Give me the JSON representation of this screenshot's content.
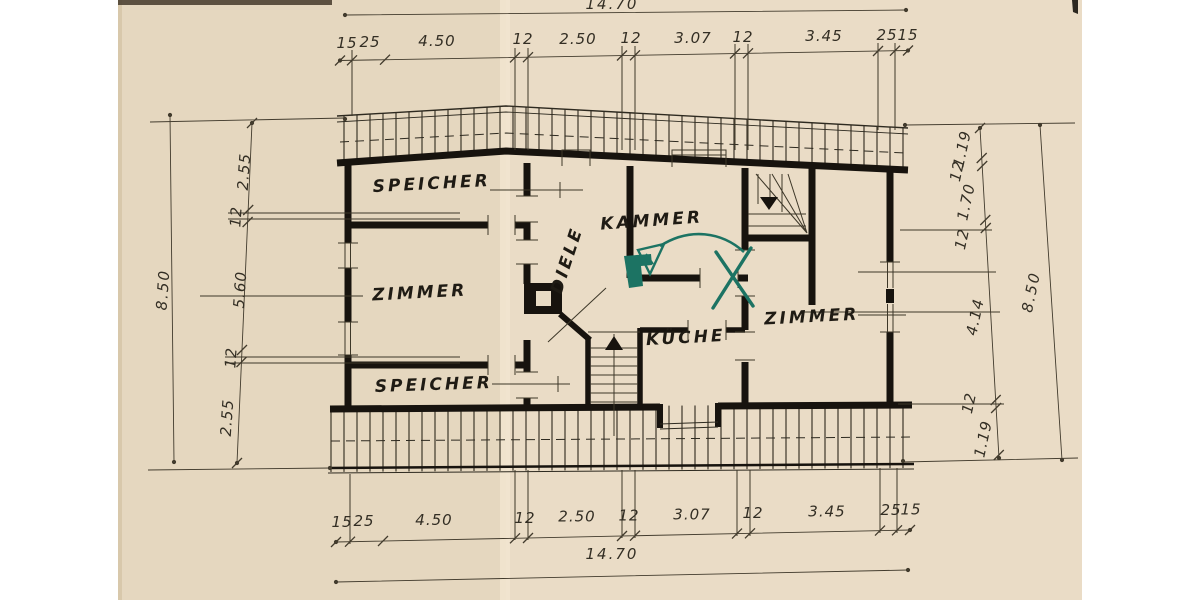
{
  "colors": {
    "paper": "#e8dbc4",
    "paper_left": "#e5d7bf",
    "paper_right": "#eadcc6",
    "ink": "#38321f",
    "wall": "#17130e",
    "annotation_green": "#1c7363"
  },
  "plan": {
    "rooms": [
      {
        "id": "speicher-top",
        "label": "SPEICHER"
      },
      {
        "id": "zimmer-left",
        "label": "ZIMMER"
      },
      {
        "id": "speicher-bottom",
        "label": "SPEICHER"
      },
      {
        "id": "diele",
        "label": "DIELE"
      },
      {
        "id": "kammer",
        "label": "KAMMER"
      },
      {
        "id": "kueche",
        "label": "KÜCHE"
      },
      {
        "id": "zimmer-right",
        "label": "ZIMMER"
      }
    ]
  },
  "dimensions": {
    "top": {
      "total": "14.70",
      "segments": [
        "15",
        "25",
        "4.50",
        "12",
        "2.50",
        "12",
        "3.07",
        "12",
        "3.45",
        "25",
        "15"
      ]
    },
    "bottom": {
      "total": "14.70",
      "segments": [
        "15",
        "25",
        "4.50",
        "12",
        "2.50",
        "12",
        "3.07",
        "12",
        "3.45",
        "25",
        "15"
      ]
    },
    "left": {
      "total": "8.50",
      "segments": [
        "2.55",
        "12",
        "5.60",
        "12",
        "2.55"
      ]
    },
    "right": {
      "total": "8.50",
      "segments": [
        "1.19",
        "12",
        "1.70",
        "12",
        "4.14",
        "12",
        "1.19"
      ]
    }
  }
}
